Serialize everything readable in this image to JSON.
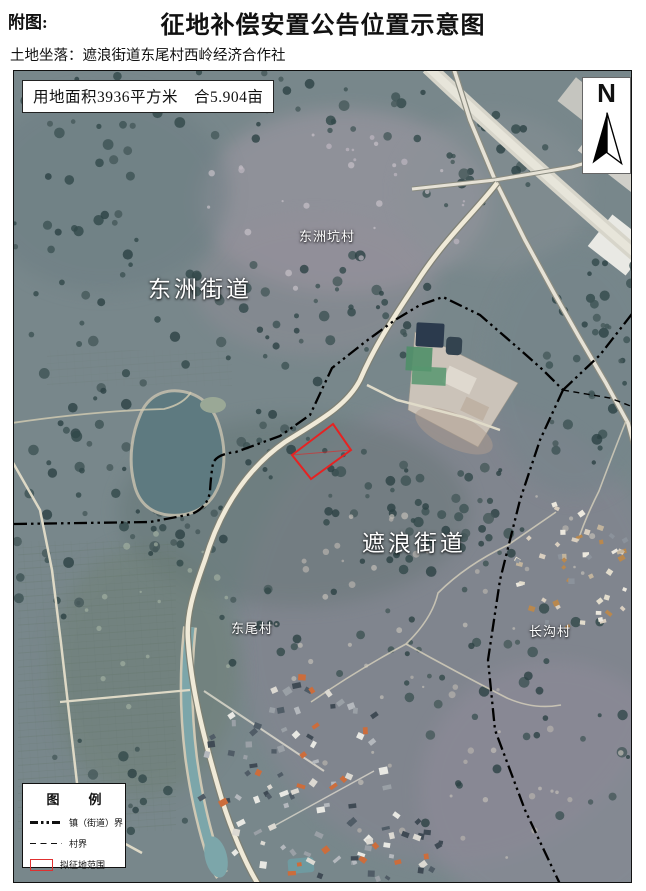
{
  "header": {
    "prefix": "附图:",
    "title": "征地补偿安置公告位置示意图",
    "location_label": "土地坐落：遮浪街道东尾村西岭经济合作社"
  },
  "map": {
    "area_note": "用地面积3936平方米　合5.904亩",
    "compass": {
      "label": "N"
    },
    "labels": {
      "street_dongzhou": "东洲街道",
      "street_zhelang": "遮浪街道",
      "village_dongzhoukeng": "东洲坑村",
      "village_dongwei": "东尾村",
      "village_changgou": "长沟村"
    },
    "legend": {
      "title": "图　例",
      "items": [
        {
          "label": "镇（街道）界"
        },
        {
          "label": "村界"
        },
        {
          "label": "拟征地范围"
        }
      ]
    },
    "colors": {
      "boundary_line": "#000000",
      "parcel_outline": "#e62222"
    }
  }
}
